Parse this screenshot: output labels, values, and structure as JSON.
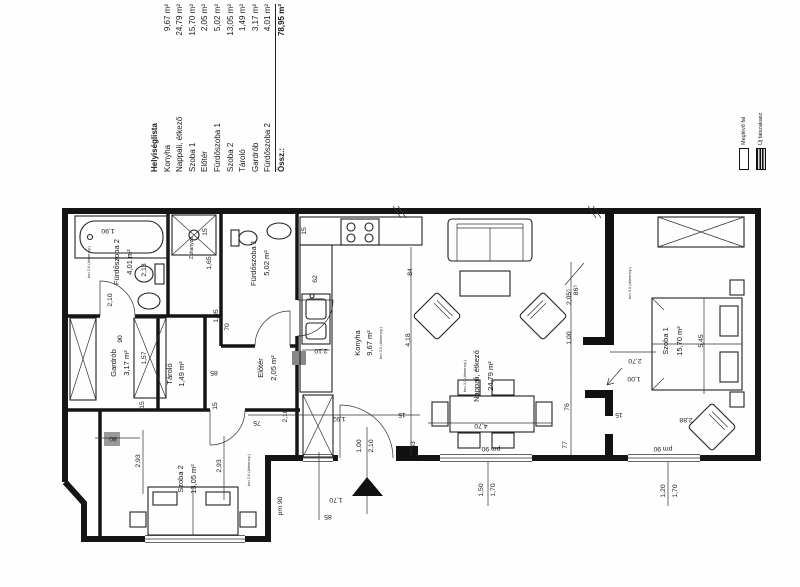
{
  "legend": {
    "title": "Helyiséglista",
    "rows": [
      {
        "name": "Konyha",
        "area": "9,67 m²"
      },
      {
        "name": "Nappali, étkező",
        "area": "24,79 m²"
      },
      {
        "name": "Szoba 1",
        "area": "15,70 m²"
      },
      {
        "name": "Előtér",
        "area": "2,05 m²"
      },
      {
        "name": "Fürdőszoba 1",
        "area": "5,02 m²"
      },
      {
        "name": "Szoba 2",
        "area": "13,05 m²"
      },
      {
        "name": "Tároló",
        "area": "1,49 m²"
      },
      {
        "name": "Gardrób",
        "area": "3,17 m²"
      },
      {
        "name": "Fürdőszoba 2",
        "area": "4,01 m²"
      }
    ],
    "total": {
      "name": "Össz.:",
      "area": "78,95 m²"
    }
  },
  "wall_legend": {
    "existing": "Meglévő fal",
    "new": "Új falszakasz"
  },
  "rooms": {
    "fsz2": {
      "name": "Fürdőszoba 2",
      "area": "4,01 m²",
      "ceiling": "bm 2,6 (álmenny.)"
    },
    "zuhanyzo": {
      "name": "Zuhanyzó"
    },
    "fsz1": {
      "name": "Fürdőszoba 1",
      "area": "5,02 m²"
    },
    "gardrob": {
      "name": "Gardrób",
      "area": "3,17 m²"
    },
    "tarolo": {
      "name": "Tároló",
      "area": "1,49 m²"
    },
    "eloter": {
      "name": "Előtér",
      "area": "2,05 m²"
    },
    "konyha": {
      "name": "Konyha",
      "area": "9,67 m²",
      "ceiling": "bm 3,0 (álmenny.)"
    },
    "nappali": {
      "name": "Nappali, étkező",
      "area": "24,79 m²",
      "ceiling": "bm 3,0 (álmenny.)"
    },
    "szoba1": {
      "name": "Szoba 1",
      "area": "15,70 m²",
      "ceiling": "bm 3,0 (álmenny.)"
    },
    "szoba2": {
      "name": "Szoba 2",
      "area": "13,05 m²",
      "ceiling": "bm 2,6 (álmenny.)"
    }
  },
  "dims": [
    "15",
    "84",
    "86⁵",
    "4,18",
    "2,05⁵",
    "1,00",
    "76",
    "77",
    "63",
    "1,90",
    "2,13",
    "2,10",
    "1,65",
    "15",
    "62",
    "2,10",
    "70",
    "1,05",
    "85",
    "1,92",
    "15",
    "1,00",
    "2,10",
    "4,70",
    "pm 90",
    "1,50",
    "1,70",
    "pm 90",
    "1,20",
    "1,70",
    "2,88",
    "15",
    "2,70",
    "1,00",
    "5,45",
    "2,93",
    "2,93",
    "80",
    "pm 90",
    "1,70",
    "85",
    "90",
    "1,57",
    "2,10",
    "75",
    "15",
    "15"
  ]
}
